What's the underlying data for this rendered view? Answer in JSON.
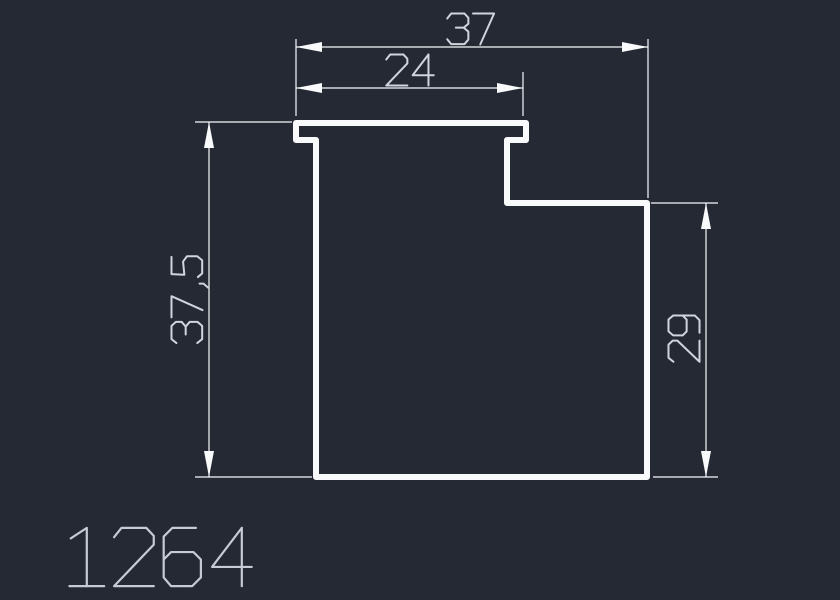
{
  "part_number": "1264",
  "colors": {
    "background": "#242933",
    "line": "#f8fafc",
    "dim_text": "#cfd5df",
    "title_text": "#c6cbd4"
  },
  "drawing": {
    "canvas": {
      "width": 840,
      "height": 600
    },
    "profile": {
      "name": "profile-outline",
      "stroke_width": 6,
      "points": [
        [
          296,
          123
        ],
        [
          526,
          123
        ],
        [
          526,
          140
        ],
        [
          507,
          140
        ],
        [
          507,
          203
        ],
        [
          647,
          203
        ],
        [
          647,
          477
        ],
        [
          316,
          477
        ],
        [
          316,
          140
        ],
        [
          296,
          140
        ]
      ]
    },
    "dimensions": [
      {
        "name": "dim-overall-width",
        "label": "37",
        "type": "h",
        "line": [
          296,
          47,
          648,
          47
        ],
        "ext": [
          [
            296,
            39,
            296,
            116
          ],
          [
            648,
            39,
            648,
            198
          ]
        ],
        "text": [
          471,
          29
        ],
        "size": 33
      },
      {
        "name": "dim-top-flange-width",
        "label": "24",
        "type": "h",
        "line": [
          296,
          88,
          523,
          88
        ],
        "ext": [
          [
            523,
            72,
            523,
            116
          ]
        ],
        "text": [
          410,
          70
        ],
        "size": 33
      },
      {
        "name": "dim-overall-height",
        "label": "37,5",
        "type": "v",
        "line": [
          209,
          122,
          209,
          477
        ],
        "ext": [
          [
            195,
            122,
            292,
            122
          ],
          [
            195,
            477,
            312,
            477
          ]
        ],
        "text": [
          187,
          299
        ],
        "size": 33
      },
      {
        "name": "dim-right-height",
        "label": "29",
        "type": "v",
        "line": [
          706,
          203,
          706,
          477
        ],
        "ext": [
          [
            651,
            203,
            718,
            203
          ],
          [
            653,
            477,
            718,
            477
          ]
        ],
        "text": [
          684,
          338
        ],
        "size": 33
      }
    ],
    "title": {
      "name": "part-number",
      "pos": [
        62,
        526
      ],
      "size": 62
    },
    "arrow": {
      "length": 26,
      "half_width": 5
    },
    "thin_stroke": 1.2,
    "glyph_stroke": 2
  }
}
